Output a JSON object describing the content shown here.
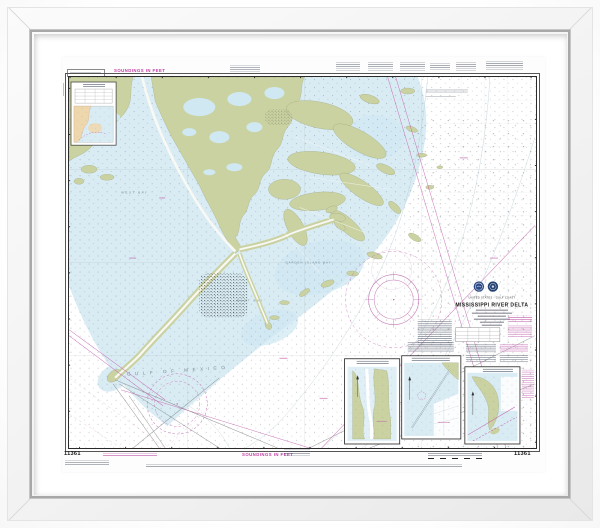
{
  "photo": {
    "background": "#ffffff"
  },
  "frame": {
    "face_color": "#f2f2f2",
    "lip_color": "#a8a8a8",
    "mat_color": "#ffffff"
  },
  "chart": {
    "number": "11361",
    "title": "MISSISSIPPI RIVER DELTA",
    "region": "UNITED STATES - GULF COAST",
    "soundings_note": "SOUNDINGS IN FEET",
    "seals": [
      "noaa-seal-icon",
      "commerce-seal-icon"
    ],
    "map_labels": {
      "gulf": "GULF OF MEXICO",
      "west_bay": "WEST BAY",
      "east_bay": "EAST BAY",
      "garden_bay": "GARDEN ISLAND BAY"
    },
    "colors": {
      "water": "#d9ecf4",
      "shallow_water": "#c9e3ef",
      "land": "#cbd2a2",
      "inset_land": "#eed7ad",
      "magenta": "#c25ead",
      "ink": "#222222"
    }
  }
}
